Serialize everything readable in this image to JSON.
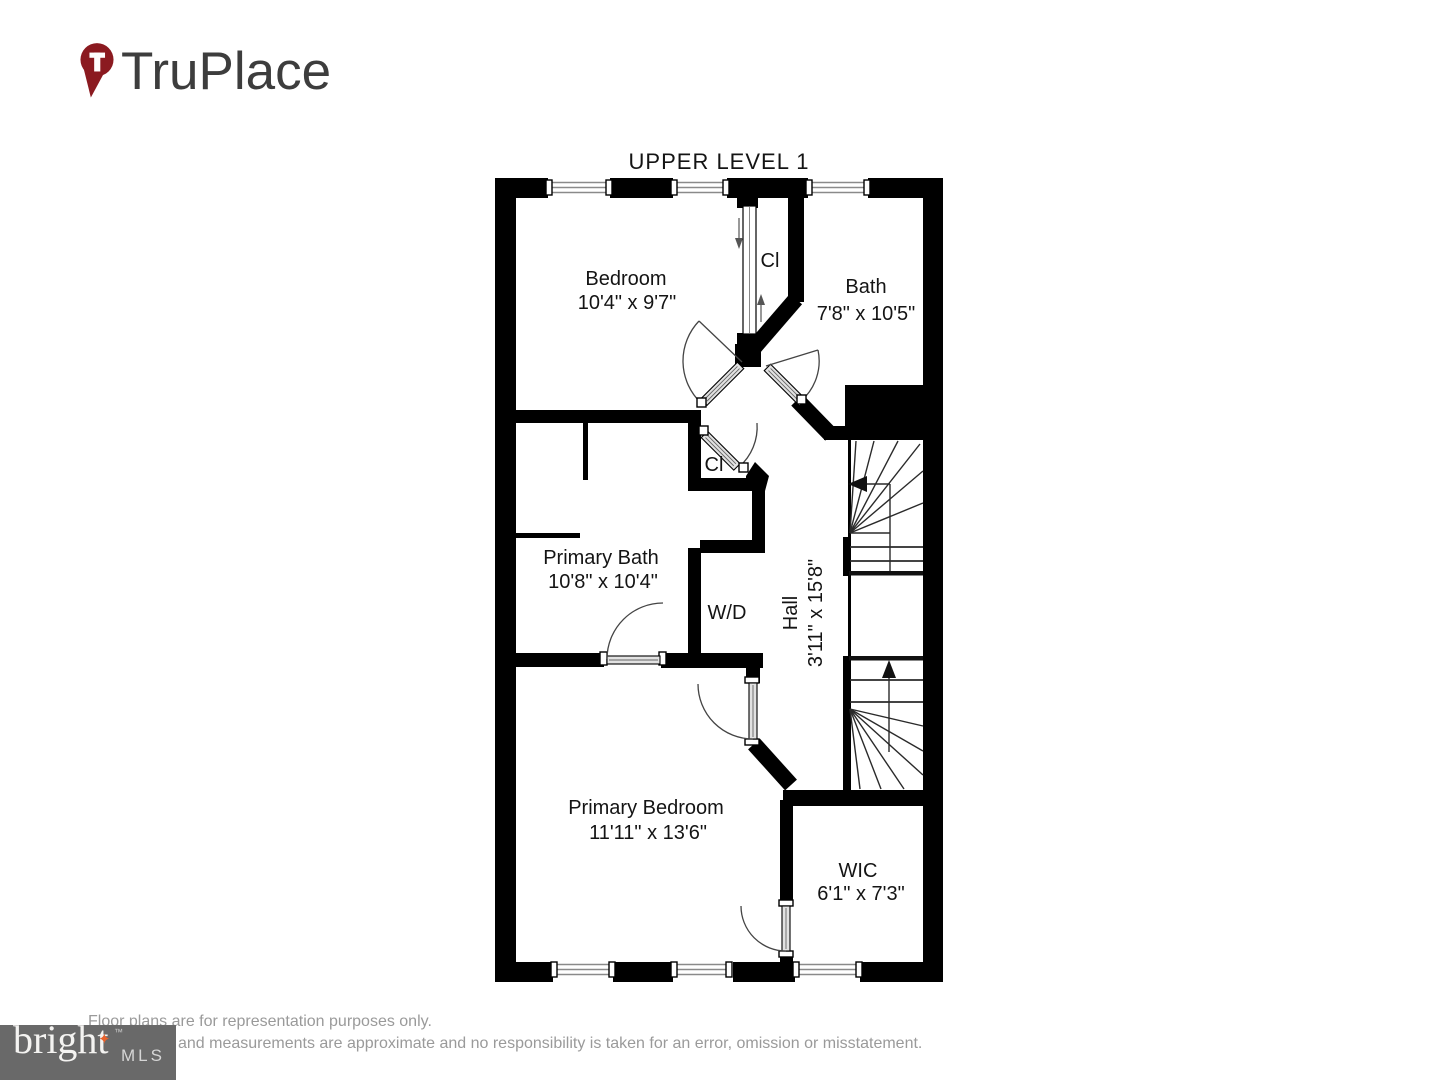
{
  "header": {
    "brand": "TruPlace",
    "pin_color": "#8b1a20",
    "text_color": "#3d3d3d"
  },
  "floor_plan": {
    "title": "UPPER LEVEL 1",
    "wall_color": "#000000",
    "rooms": [
      {
        "id": "bedroom",
        "name": "Bedroom",
        "dimensions": "10'4\" x 9'7\""
      },
      {
        "id": "closet-top",
        "name": "Cl",
        "dimensions": ""
      },
      {
        "id": "bath",
        "name": "Bath",
        "dimensions": "7'8\" x 10'5\""
      },
      {
        "id": "primary-bath",
        "name": "Primary Bath",
        "dimensions": "10'8\" x 10'4\""
      },
      {
        "id": "closet-middle",
        "name": "Cl",
        "dimensions": ""
      },
      {
        "id": "laundry",
        "name": "W/D",
        "dimensions": ""
      },
      {
        "id": "hall",
        "name": "Hall",
        "dimensions": "3'11\" x 15'8\""
      },
      {
        "id": "primary-bedroom",
        "name": "Primary Bedroom",
        "dimensions": "11'11\" x 13'6\""
      },
      {
        "id": "wic",
        "name": "WIC",
        "dimensions": "6'1\" x 7'3\""
      }
    ]
  },
  "footer": {
    "disclaimer_line1": "Floor plans are for representation purposes only.",
    "disclaimer_line2": "and measurements are approximate and no responsibility is taken for an error, omission or misstatement.",
    "mls_logo": {
      "word": "bright",
      "suffix": "MLS",
      "trademark": "™",
      "star": "✦",
      "box_color": "#696969",
      "star_color": "#e8622c"
    }
  }
}
